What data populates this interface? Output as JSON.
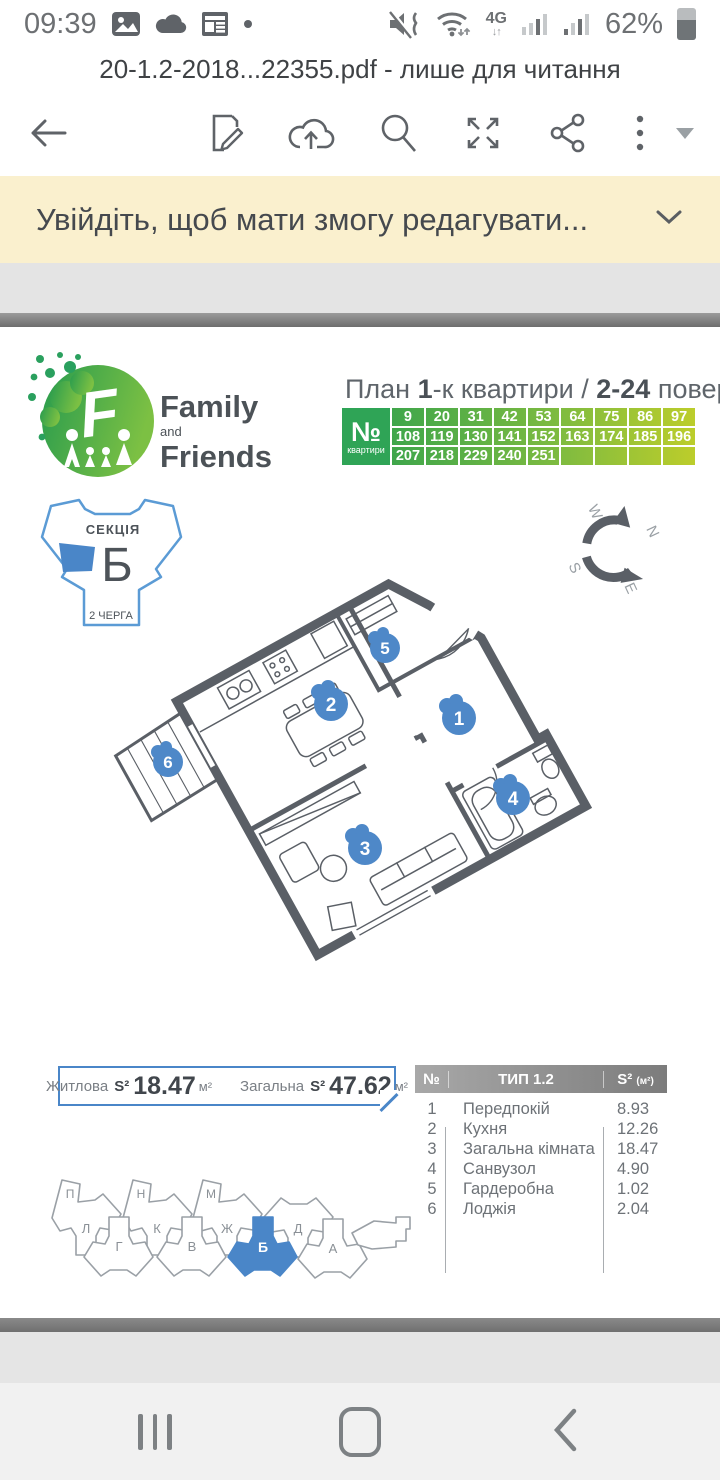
{
  "status": {
    "time": "09:39",
    "network": "4G",
    "net_arrows": "↓↑",
    "battery": "62%"
  },
  "title_bar": {
    "title": "20-1.2-2018...22355.pdf - лише для читання"
  },
  "banner": {
    "message": "Увійдіть, щоб мати змогу редагувати..."
  },
  "logo": {
    "family": "Family",
    "and": "and",
    "friends": "Friends"
  },
  "plan_header": {
    "prefix": "План ",
    "bold1": "1",
    "middle": "-к квартири / ",
    "bold2": "2-24",
    "suffix": " поверхи"
  },
  "apt_numbers": {
    "no": "№",
    "sub": "квартири",
    "rows": [
      [
        "9",
        "20",
        "31",
        "42",
        "53",
        "64",
        "75",
        "86",
        "97"
      ],
      [
        "108",
        "119",
        "130",
        "141",
        "152",
        "163",
        "174",
        "185",
        "196"
      ],
      [
        "207",
        "218",
        "229",
        "240",
        "251",
        "",
        "",
        "",
        ""
      ]
    ]
  },
  "section_map": {
    "label": "СЕКЦІЯ",
    "letter": "Б",
    "phase": "2 ЧЕРГА"
  },
  "compass": {
    "n": "N",
    "e": "E",
    "s": "S",
    "w": "W"
  },
  "badges": [
    "1",
    "2",
    "3",
    "4",
    "5",
    "6"
  ],
  "areas": {
    "living_label": "Житлова",
    "living_s": "S²",
    "living_value": "18.47",
    "living_unit": "м²",
    "total_label": "Загальна",
    "total_s": "S²",
    "total_value": "47.62",
    "total_unit": "м²"
  },
  "rooms": {
    "h_no": "№",
    "h_type": "ТИП 1.2",
    "h_area": "S²",
    "h_area_unit": "(м²)",
    "rows": [
      [
        "1",
        "Передпокій",
        "8.93"
      ],
      [
        "2",
        "Кухня",
        "12.26"
      ],
      [
        "3",
        "Загальна кімната",
        "18.47"
      ],
      [
        "4",
        "Санвузол",
        "4.90"
      ],
      [
        "5",
        "Гардеробна",
        "1.02"
      ],
      [
        "6",
        "Лоджія",
        "2.04"
      ]
    ]
  },
  "site": {
    "sections": [
      "П",
      "Л",
      "Г",
      "Н",
      "К",
      "В",
      "М",
      "Ж",
      "Б",
      "Д",
      "А"
    ]
  },
  "colors": {
    "green": "#2fa456",
    "blue": "#4a86c8",
    "badge_blue": "#4e88c8",
    "wall": "#5a5f66",
    "banner_bg": "#faf0ce"
  }
}
